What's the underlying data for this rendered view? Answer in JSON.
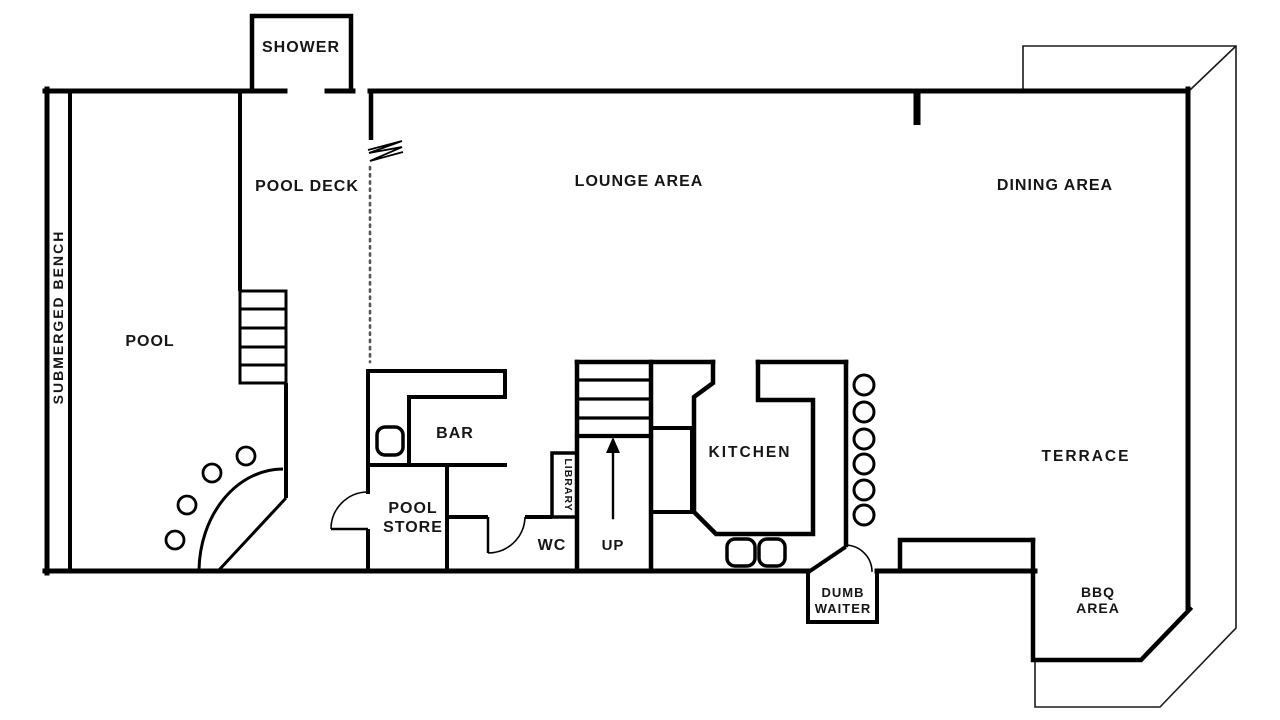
{
  "diagram": {
    "kind": "floor-plan",
    "background_color": "#ffffff",
    "wall_color": "#000000",
    "text_color": "#161616"
  },
  "rooms": {
    "shower": {
      "label": "SHOWER"
    },
    "pool_deck": {
      "label": "POOL DECK"
    },
    "lounge": {
      "label": "LOUNGE AREA"
    },
    "dining": {
      "label": "DINING AREA"
    },
    "submerged_bench": {
      "label": "SUBMERGED BENCH"
    },
    "pool": {
      "label": "POOL"
    },
    "bar": {
      "label": "BAR"
    },
    "pool_store": {
      "line1": "POOL",
      "line2": "STORE"
    },
    "library": {
      "label": "LIBRARY"
    },
    "wc": {
      "label": "WC"
    },
    "stairs": {
      "label": "UP"
    },
    "kitchen": {
      "label": "KITCHEN"
    },
    "terrace": {
      "label": "TERRACE"
    },
    "dumb_waiter": {
      "line1": "DUMB",
      "line2": "WAITER"
    },
    "bbq": {
      "line1": "BBQ",
      "line2": "AREA"
    }
  },
  "features": {
    "pool_stool_count": 4,
    "terrace_circle_count": 6,
    "pool_step_count": 5,
    "stair_tread_count": 4
  }
}
